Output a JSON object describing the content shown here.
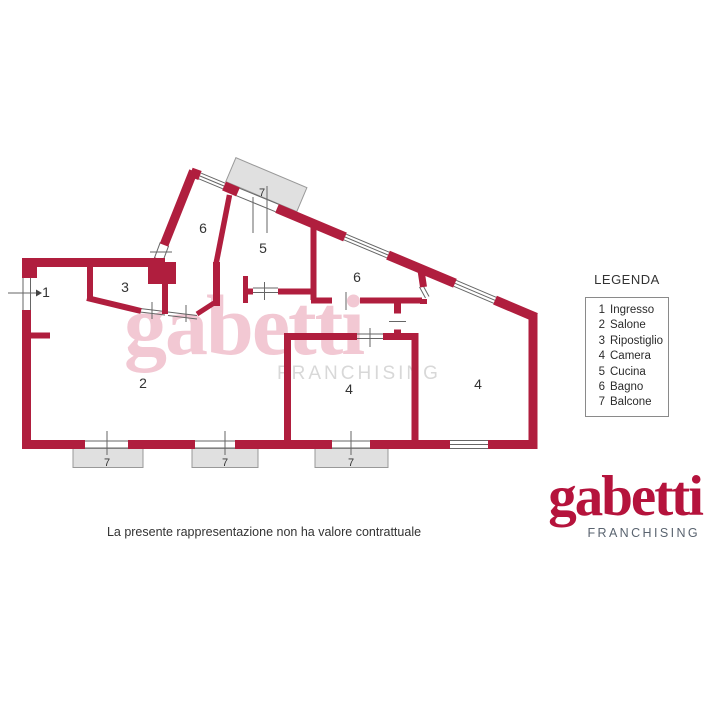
{
  "colors": {
    "wall": "#B01E3E",
    "logo_red": "#B5133C",
    "watermark_pink": "#F2C8D3",
    "watermark_gray": "#D8D8D8",
    "balcony_fill": "#E0E0E0",
    "balcony_border": "#999999",
    "thin_line": "#666666",
    "text": "#333333",
    "franchising_gray": "#5A6470"
  },
  "plan": {
    "rooms": [
      {
        "text": "1"
      },
      {
        "text": "3"
      },
      {
        "text": "2"
      },
      {
        "text": "6"
      },
      {
        "text": "5"
      },
      {
        "text": "6"
      },
      {
        "text": "4"
      },
      {
        "text": "4"
      }
    ],
    "balconies": [
      {
        "text": "7"
      },
      {
        "text": "7"
      },
      {
        "text": "7"
      },
      {
        "text": "7"
      }
    ]
  },
  "legend": {
    "title": "LEGENDA",
    "items": [
      {
        "num": "1",
        "label": "Ingresso"
      },
      {
        "num": "2",
        "label": "Salone"
      },
      {
        "num": "3",
        "label": "Ripostiglio"
      },
      {
        "num": "4",
        "label": "Camera"
      },
      {
        "num": "5",
        "label": "Cucina"
      },
      {
        "num": "6",
        "label": "Bagno"
      },
      {
        "num": "7",
        "label": "Balcone"
      }
    ]
  },
  "watermark": {
    "brand": "gabetti",
    "sub": "FRANCHISING"
  },
  "logo": {
    "brand": "gabetti",
    "sub": "FRANCHISING"
  },
  "footer": {
    "disclaimer": "La presente rappresentazione non ha valore contrattuale"
  }
}
